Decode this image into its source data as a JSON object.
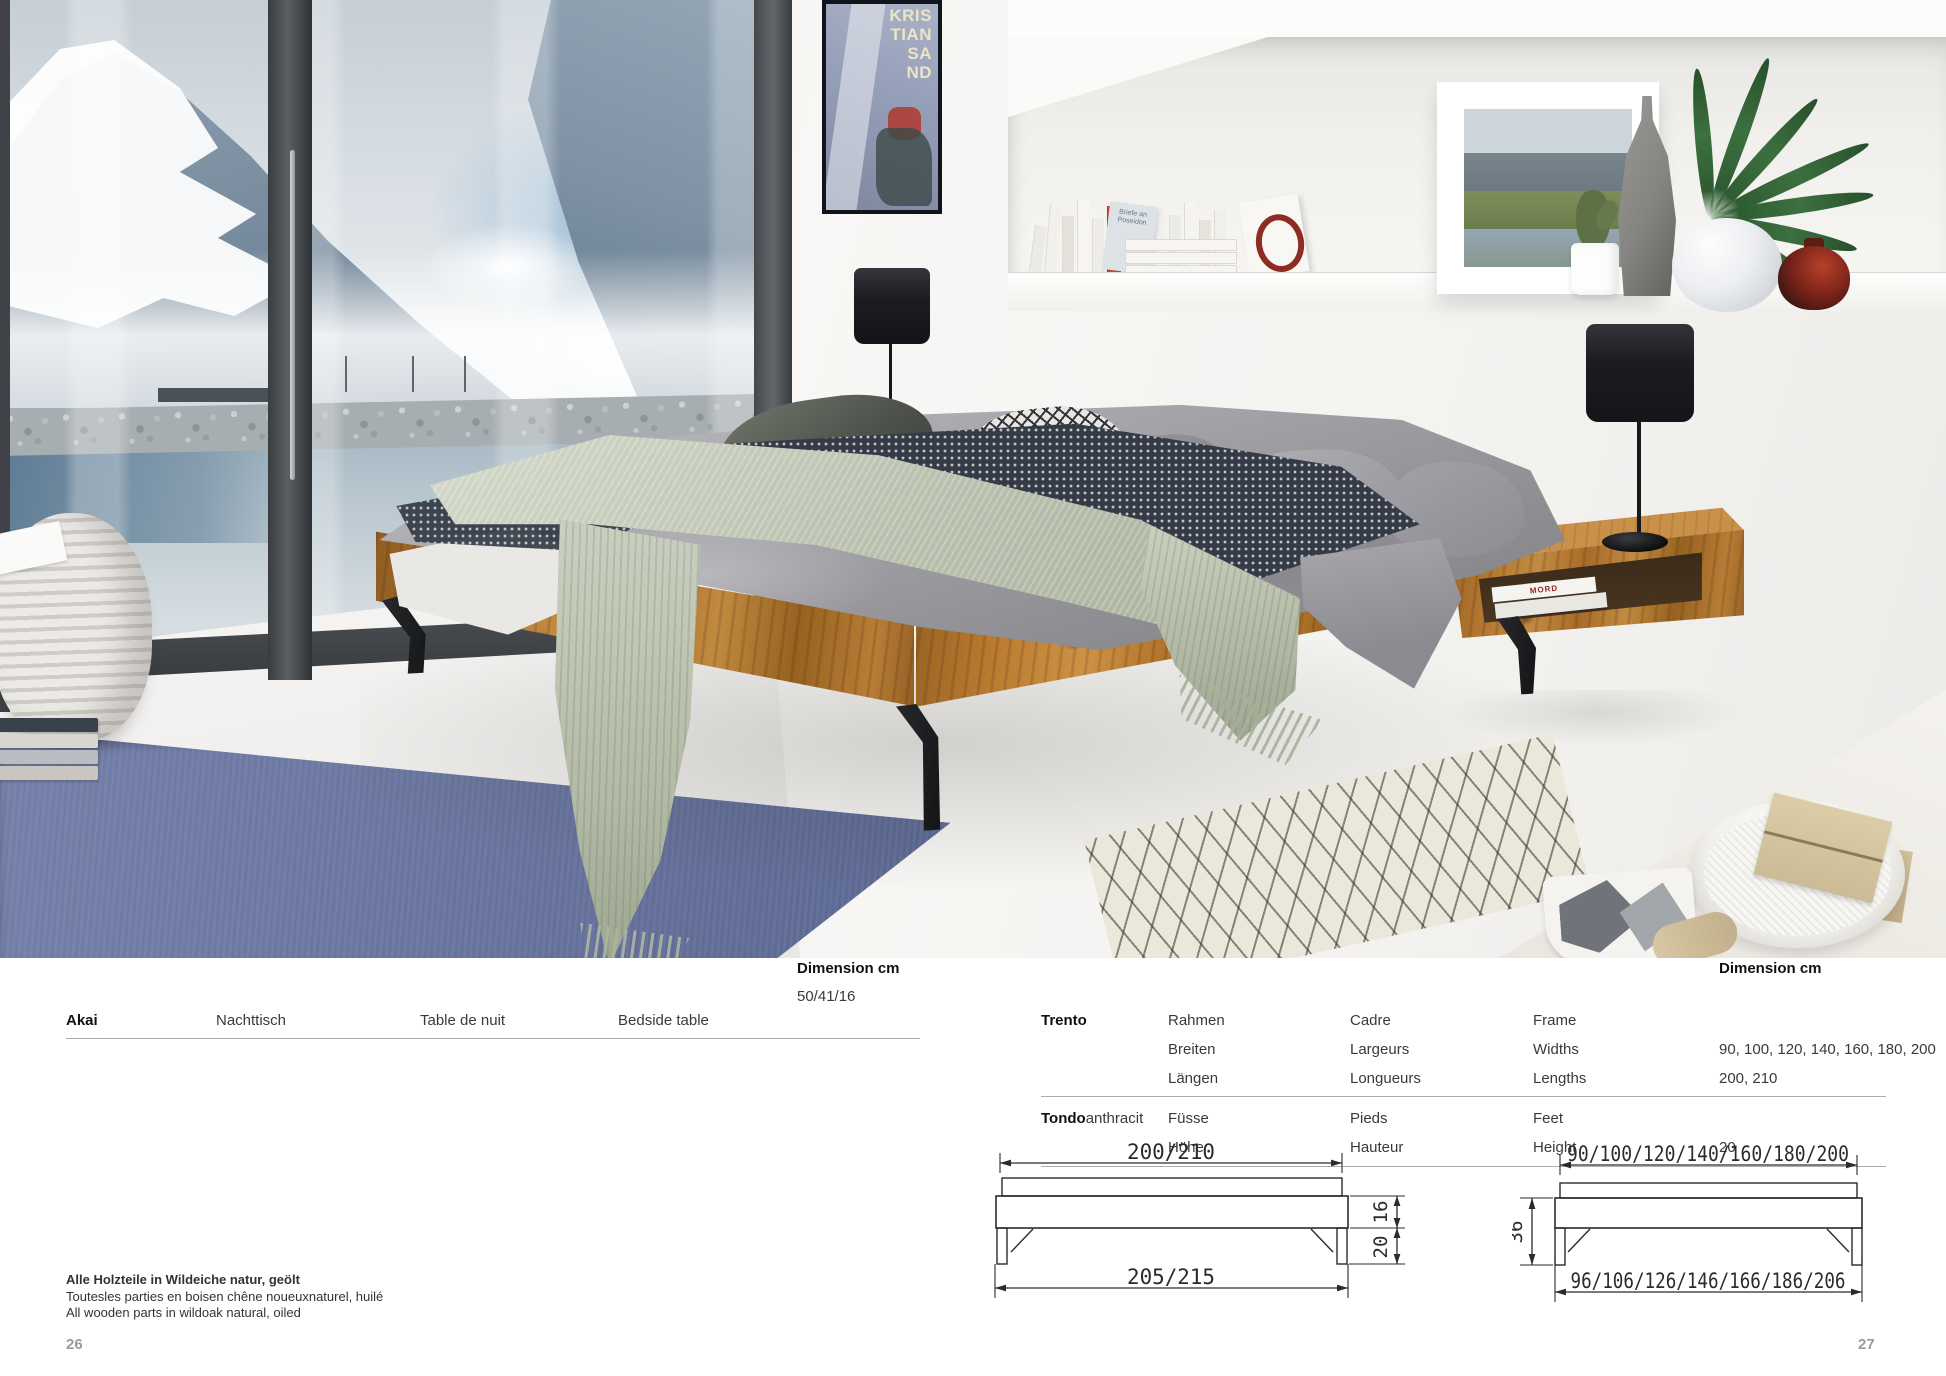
{
  "catalog": {
    "akai": {
      "product": "Akai",
      "dimension_label": "Dimension cm",
      "dimension_value": "50/41/16",
      "label_de": "Nachttisch",
      "label_fr": "Table de nuit",
      "label_en": "Bedside table"
    },
    "trento": {
      "dimension_label": "Dimension cm",
      "row1": {
        "product": "Trento",
        "de1": "Rahmen",
        "de2": "Breiten",
        "de3": "Längen",
        "fr1": "Cadre",
        "fr2": "Largeurs",
        "fr3": "Longueurs",
        "en1": "Frame",
        "en2": "Widths",
        "en3": "Lengths",
        "widths_values": "90, 100, 120, 140, 160, 180, 200",
        "lengths_values": "200, 210"
      },
      "row2": {
        "product": "Tondo",
        "variant": "anthracit",
        "de1": "Füsse",
        "de2": "Höhe",
        "fr1": "Pieds",
        "fr2": "Hauteur",
        "en1": "Feet",
        "en2": "Height",
        "height_value": "20"
      }
    },
    "materials_note": {
      "de": "Alle Holzteile in Wildeiche natur, geölt",
      "fr": "Toutesles parties en boisen chêne noueuxnaturel, huilé",
      "en": "All wooden parts in wildoak natural, oiled"
    },
    "page_numbers": {
      "left": "26",
      "right": "27"
    }
  },
  "drawings": {
    "side_view": {
      "top_width": "200/210",
      "bottom_width": "205/215",
      "frame_height": "16",
      "feet_height": "20"
    },
    "front_view": {
      "top_width": "90/100/120/140/160/180/200",
      "bottom_width": "96/106/126/146/166/186/206",
      "total_height": "36"
    }
  },
  "photo": {
    "poster": {
      "line1": "KRIS",
      "line2": "TIAN",
      "line3": "SA",
      "line4": "ND"
    },
    "books": {
      "spine_title": "MORD",
      "leaning_title": "Briefe an Poseidon"
    },
    "colors": {
      "oak_wood": "#b2762f",
      "sage_throw": "#c0c8b4",
      "rug_blue": "#6d79a4",
      "leg_metal": "#1d1f22",
      "accent_red_vase": "#7e241a"
    }
  }
}
